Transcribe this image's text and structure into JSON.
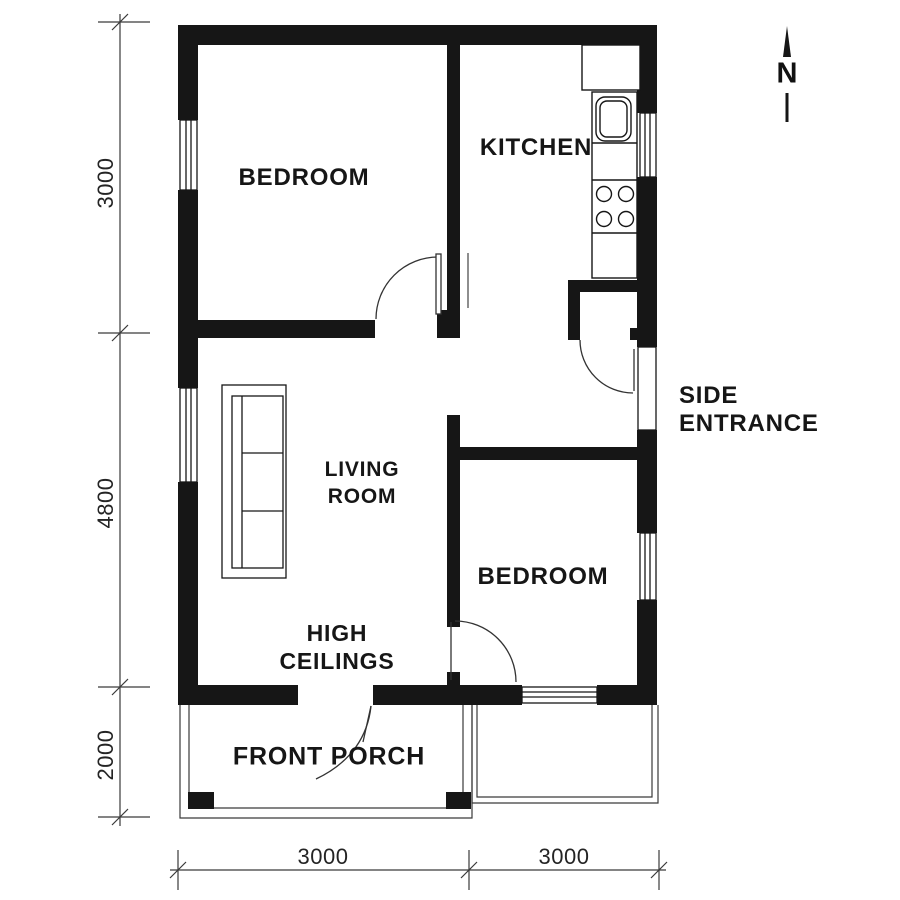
{
  "meta": {
    "drawing_type": "residential floor plan"
  },
  "colors": {
    "ink": "#161616",
    "dim_line": "#3a3a3a",
    "bg": "#ffffff"
  },
  "north": {
    "label": "N",
    "icon": "north-arrow-icon"
  },
  "rooms": {
    "bedroom1": {
      "label": "BEDROOM"
    },
    "kitchen": {
      "label": "KITCHEN"
    },
    "living": {
      "line1": "LIVING",
      "line2": "ROOM"
    },
    "bedroom2": {
      "label": "BEDROOM"
    },
    "porch": {
      "label": "FRONT PORCH"
    }
  },
  "annotations": {
    "side_entrance": {
      "line1": "SIDE",
      "line2": "ENTRANCE"
    },
    "high_ceilings": {
      "line1": "HIGH",
      "line2": "CEILINGS"
    }
  },
  "dimensions": {
    "left": [
      {
        "value": "3000"
      },
      {
        "value": "4800"
      },
      {
        "value": "2000"
      }
    ],
    "bottom": [
      {
        "value": "3000"
      },
      {
        "value": "3000"
      }
    ]
  },
  "fixtures": {
    "sofa": "sofa-icon",
    "sink": "kitchen-sink-icon",
    "stove": "stove-four-burner-icon",
    "doors": "door-swing-icon",
    "windows": "window-icon"
  }
}
